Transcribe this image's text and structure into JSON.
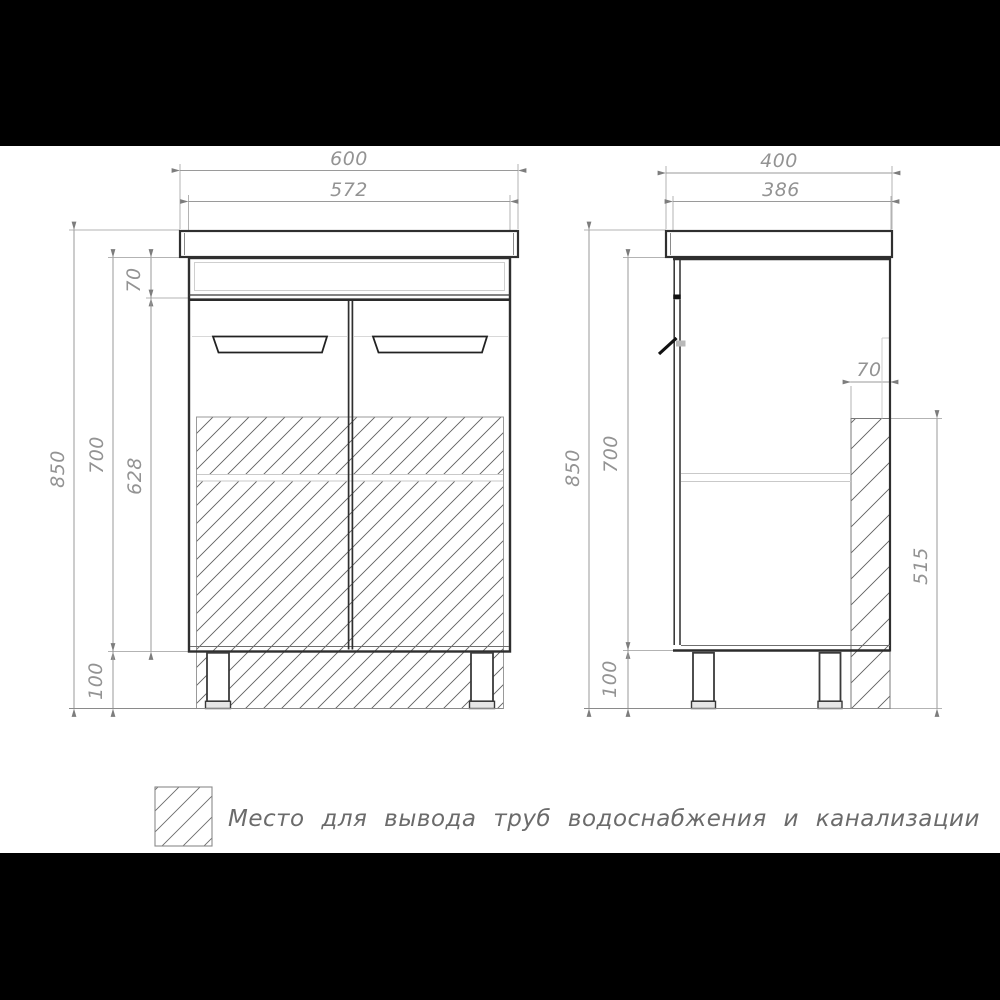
{
  "front": {
    "total_width": "600",
    "cabinet_width": "572",
    "total_height": "850",
    "cabinet_height": "700",
    "inner_height": "628",
    "top_panel_height": "70",
    "leg_height": "100"
  },
  "side": {
    "total_depth": "400",
    "cabinet_depth": "386",
    "total_height": "850",
    "cabinet_height": "700",
    "pipe_zone_width": "70",
    "pipe_zone_height": "515",
    "leg_height": "100"
  },
  "legend": {
    "note": "Место для вывода труб водоснабжения и канализации"
  },
  "colors": {
    "outline_ink": "#2f2f2f",
    "dimension_gray": "#939393",
    "hatch_gray": "#5f5f5f",
    "letterbox": "#000000"
  }
}
